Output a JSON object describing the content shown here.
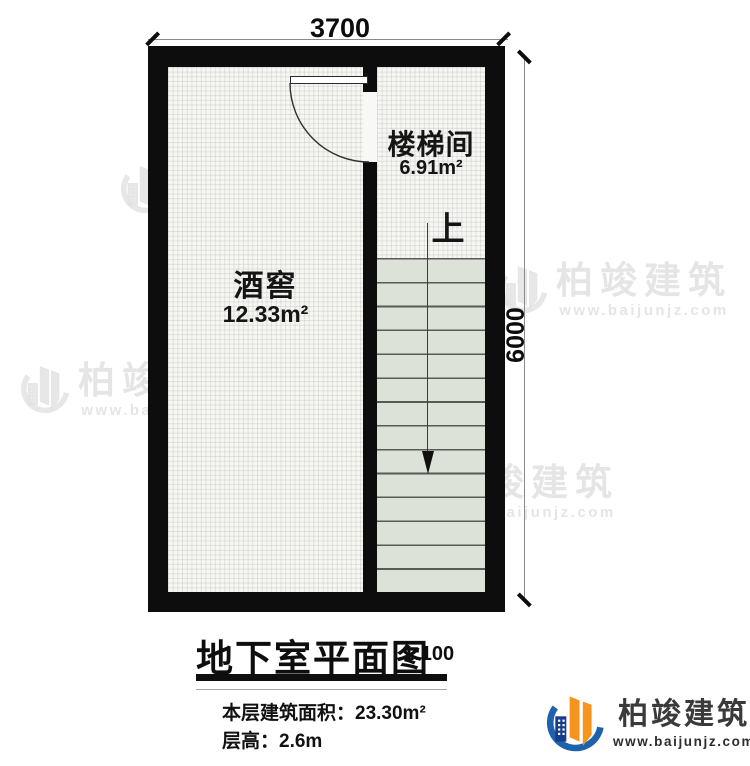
{
  "plan": {
    "dimension_width": "3700",
    "dimension_height": "6000",
    "rooms": {
      "stairwell": {
        "name": "楼梯间",
        "area": "6.91m²"
      },
      "wine_cellar": {
        "name": "酒窖",
        "area": "12.33m²"
      }
    },
    "stairs": {
      "direction_label": "上",
      "step_count": 14
    }
  },
  "title_block": {
    "title": "地下室平面图",
    "scale": "1:100",
    "area_line": "本层建筑面积：23.30m²",
    "height_line": "层高：2.6m"
  },
  "watermark": {
    "brand": "柏竣建筑",
    "url": "www.baijunjz.com"
  },
  "footer_logo": {
    "brand": "柏竣建筑",
    "url": "www.baijunjz.com"
  },
  "colors": {
    "wall": "#0d0d0d",
    "stair_tread": "#dde2d9",
    "logo_orange": "#f7941e",
    "logo_blue": "#1e62ae",
    "logo_navy": "#173c8c"
  }
}
